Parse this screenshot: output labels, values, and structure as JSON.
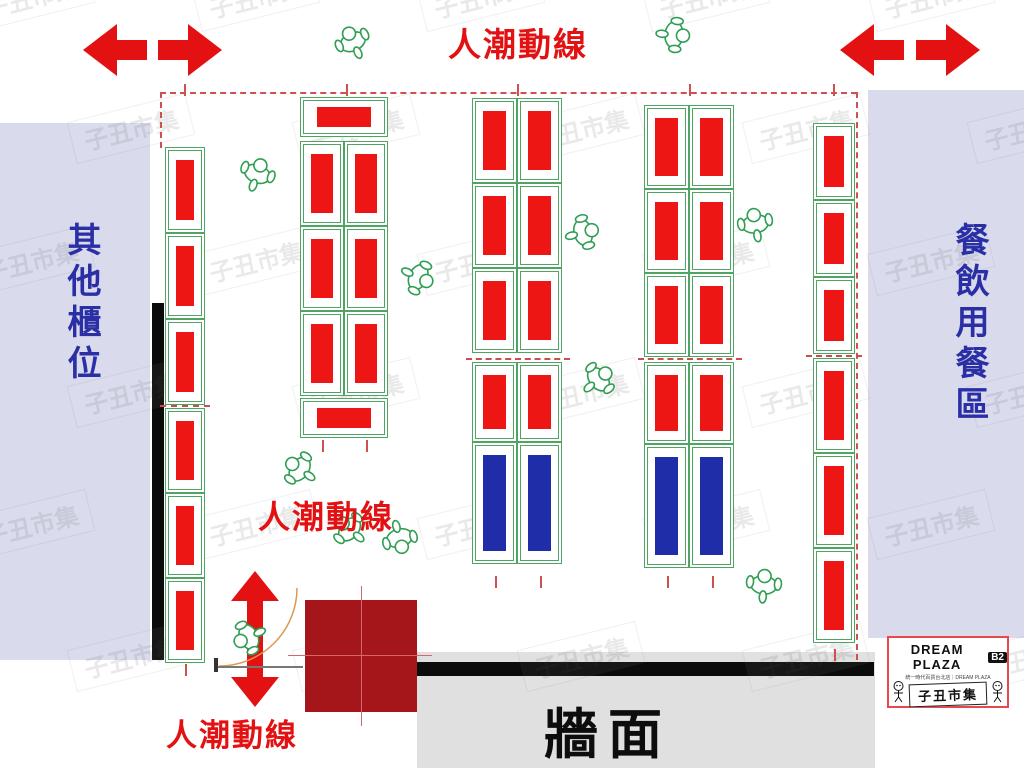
{
  "labels": {
    "flow_top": "人潮動線",
    "flow_mid": "人潮動線",
    "flow_bottom": "人潮動線",
    "left_zone": "其他櫃位",
    "right_zone": "餐飲用餐區",
    "wall": "牆面"
  },
  "logo": {
    "title": "DREAM PLAZA",
    "floor_badge": "B2",
    "subtitle": "統一時代百貨台北店｜DREAM PLAZA",
    "market_name": "子丑市集"
  },
  "watermark_text": "子丑市集",
  "colors": {
    "booth_red": "#EE1515",
    "booth_blue": "#1F2DA8",
    "booth_outline": "#4FA463",
    "accent_red": "#E31112",
    "zone_text_blue": "#2B2FA6",
    "panel_lavender": "#D9DBEC",
    "maroon_block": "#A5161B",
    "wall_gray": "#E0E0E0",
    "boundary_dash_red": "#D05050",
    "figure_green": "#2F9E53",
    "door_arc": "#D99A50"
  },
  "booth_groups": [
    {
      "x": 165,
      "y": 147,
      "w": 40,
      "rows": [
        {
          "h": 86,
          "fill": "red"
        },
        {
          "h": 86,
          "fill": "red"
        },
        {
          "h": 86,
          "fill": "red"
        }
      ]
    },
    {
      "x": 165,
      "y": 408,
      "w": 40,
      "rows": [
        {
          "h": 85,
          "fill": "red"
        },
        {
          "h": 85,
          "fill": "red"
        },
        {
          "h": 85,
          "fill": "red"
        }
      ]
    },
    {
      "x": 300,
      "y": 97,
      "w": 88,
      "rows": [
        {
          "h": 40,
          "fill": "red"
        }
      ]
    },
    {
      "x": 300,
      "y": 141,
      "w": 44,
      "rows": [
        {
          "h": 85,
          "fill": "red"
        },
        {
          "h": 85,
          "fill": "red"
        },
        {
          "h": 85,
          "fill": "red"
        }
      ]
    },
    {
      "x": 344,
      "y": 141,
      "w": 44,
      "rows": [
        {
          "h": 85,
          "fill": "red"
        },
        {
          "h": 85,
          "fill": "red"
        },
        {
          "h": 85,
          "fill": "red"
        }
      ]
    },
    {
      "x": 300,
      "y": 398,
      "w": 88,
      "rows": [
        {
          "h": 40,
          "fill": "red"
        }
      ]
    },
    {
      "x": 472,
      "y": 98,
      "w": 45,
      "rows": [
        {
          "h": 85,
          "fill": "red"
        },
        {
          "h": 85,
          "fill": "red"
        },
        {
          "h": 85,
          "fill": "red"
        }
      ]
    },
    {
      "x": 517,
      "y": 98,
      "w": 45,
      "rows": [
        {
          "h": 85,
          "fill": "red"
        },
        {
          "h": 85,
          "fill": "red"
        },
        {
          "h": 85,
          "fill": "red"
        }
      ]
    },
    {
      "x": 472,
      "y": 362,
      "w": 45,
      "rows": [
        {
          "h": 80,
          "fill": "red"
        },
        {
          "h": 122,
          "fill": "blue"
        }
      ]
    },
    {
      "x": 517,
      "y": 362,
      "w": 45,
      "rows": [
        {
          "h": 80,
          "fill": "red"
        },
        {
          "h": 122,
          "fill": "blue"
        }
      ]
    },
    {
      "x": 644,
      "y": 105,
      "w": 45,
      "rows": [
        {
          "h": 84,
          "fill": "red"
        },
        {
          "h": 84,
          "fill": "red"
        },
        {
          "h": 84,
          "fill": "red"
        }
      ]
    },
    {
      "x": 689,
      "y": 105,
      "w": 45,
      "rows": [
        {
          "h": 84,
          "fill": "red"
        },
        {
          "h": 84,
          "fill": "red"
        },
        {
          "h": 84,
          "fill": "red"
        }
      ]
    },
    {
      "x": 644,
      "y": 362,
      "w": 45,
      "rows": [
        {
          "h": 82,
          "fill": "red"
        },
        {
          "h": 124,
          "fill": "blue"
        }
      ]
    },
    {
      "x": 689,
      "y": 362,
      "w": 45,
      "rows": [
        {
          "h": 82,
          "fill": "red"
        },
        {
          "h": 124,
          "fill": "blue"
        }
      ]
    },
    {
      "x": 813,
      "y": 123,
      "w": 42,
      "rows": [
        {
          "h": 77,
          "fill": "red"
        },
        {
          "h": 77,
          "fill": "red"
        },
        {
          "h": 77,
          "fill": "red"
        }
      ]
    },
    {
      "x": 813,
      "y": 358,
      "w": 42,
      "rows": [
        {
          "h": 95,
          "fill": "red"
        },
        {
          "h": 95,
          "fill": "red"
        },
        {
          "h": 95,
          "fill": "red"
        }
      ]
    }
  ]
}
